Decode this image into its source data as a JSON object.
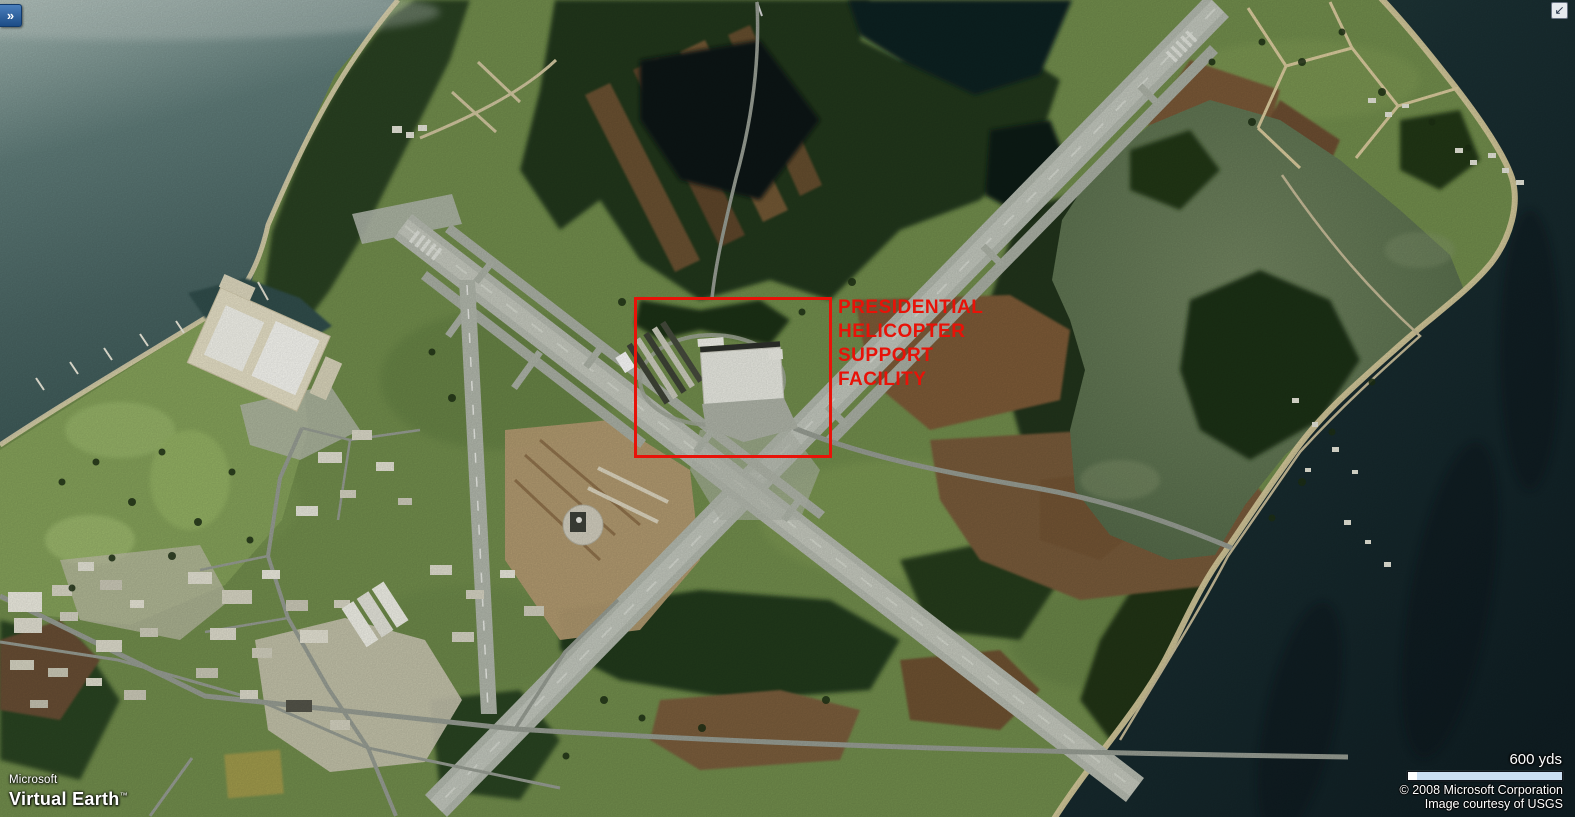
{
  "app": {
    "name": "Microsoft Virtual Earth"
  },
  "controls": {
    "expand_panel_glyph": "»",
    "minimize_map_glyph": "↙"
  },
  "logo": {
    "line1": "Microsoft",
    "line2": "Virtual Earth",
    "trademark": "™"
  },
  "annotation": {
    "lines": [
      "PRESIDENTIAL",
      "HELICOPTER",
      "SUPPORT",
      "FACILITY"
    ],
    "color": "#e81208"
  },
  "scale": {
    "label": "600 yds"
  },
  "attribution": {
    "line1": "© 2008 Microsoft Corporation",
    "line2": "Image courtesy of USGS"
  },
  "map": {
    "type": "satellite-aerial"
  },
  "colors": {
    "annotation_red": "#e81208",
    "scalebar_fill": "#cbdff2",
    "bay_water_dark": "#101f24",
    "upper_water": "#5d7a77",
    "lagoon_water": "#5d7350",
    "runway_gray": "#b9bfb4",
    "expand_button_blue": "#2a62a5"
  }
}
